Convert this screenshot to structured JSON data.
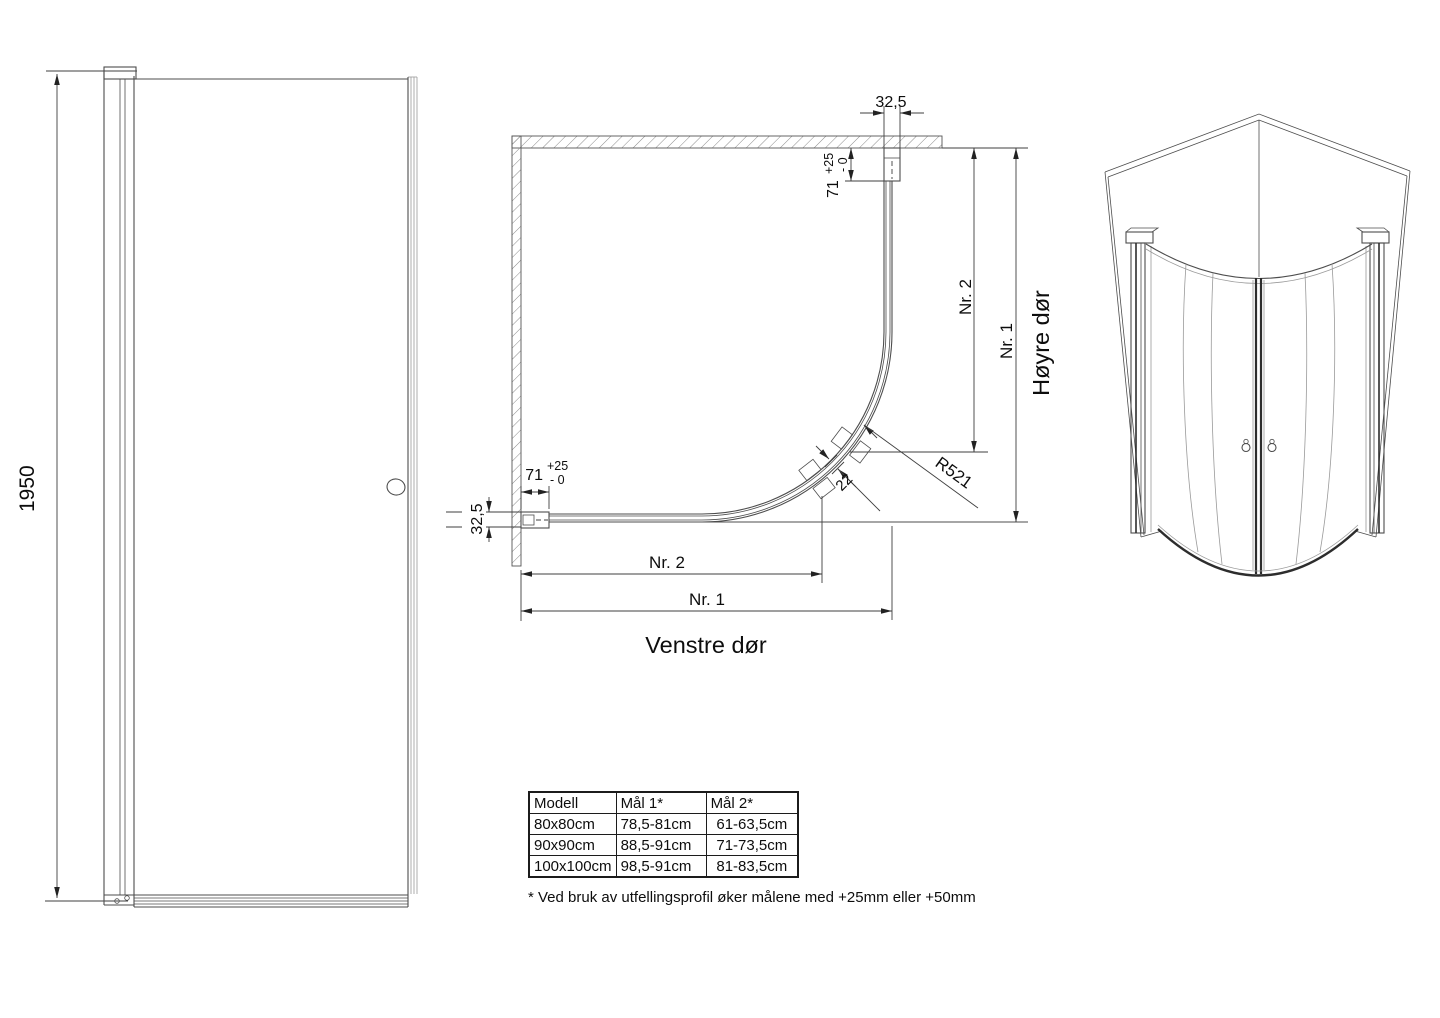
{
  "labels": {
    "height": "1950",
    "profile_width": "32,5",
    "profile_depth": "71",
    "tol_plus": "+25",
    "tol_minus": "- 0",
    "nr1": "Nr. 1",
    "nr2": "Nr. 2",
    "radius": "R521",
    "glass_thickness": "22",
    "left_door": "Venstre dør",
    "right_door": "Høyre dør"
  },
  "table": {
    "headers": [
      "Modell",
      "Mål 1*",
      "Mål 2*"
    ],
    "rows": [
      [
        "80x80cm",
        "78,5-81cm",
        "61-63,5cm"
      ],
      [
        "90x90cm",
        "88,5-91cm",
        "71-73,5cm"
      ],
      [
        "100x100cm",
        "98,5-91cm",
        "81-83,5cm"
      ]
    ]
  },
  "footnote": "* Ved bruk av utfellingsprofil øker målene med +25mm eller +50mm",
  "colors": {
    "background": "#ffffff",
    "line": "#4d4d4d",
    "dim_line": "#3f3f3f",
    "text": "#0d0d0d",
    "hatch": "#8a8a8a",
    "table_border": "#1c1c1c"
  }
}
